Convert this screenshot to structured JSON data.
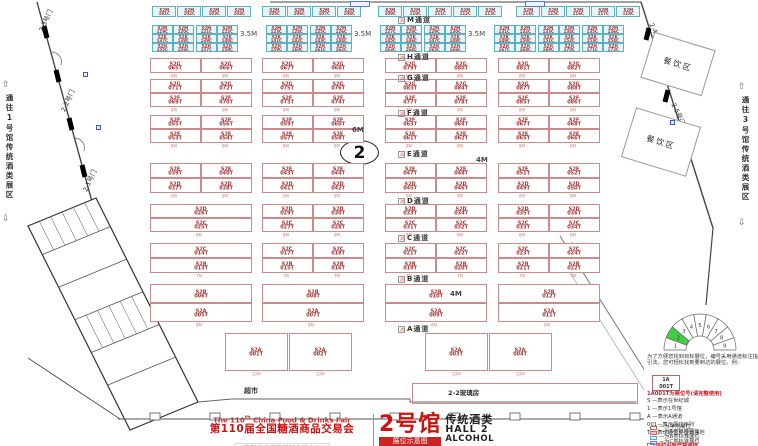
{
  "sides": {
    "left": "通往1号馆传统酒类展区",
    "right": "通往3号馆传统酒类展区"
  },
  "labels": {
    "market": "超市",
    "glass": "2-2玻璃房",
    "hall_circle": "2",
    "dining": "餐饮区",
    "aisle_icon": "消"
  },
  "gates": [
    {
      "label": "2-3号门",
      "x": 40,
      "y": 26,
      "r": -65
    },
    {
      "label": "2-2号门",
      "x": 62,
      "y": 106,
      "r": -65
    },
    {
      "label": "2-1号门",
      "x": 84,
      "y": 186,
      "r": -65
    },
    {
      "label": "2-4号门",
      "x": 652,
      "y": 18,
      "r": 65
    },
    {
      "label": "2-5号门",
      "x": 674,
      "y": 98,
      "r": 65
    }
  ],
  "dining_boxes": [
    {
      "x": 646,
      "y": 40,
      "w": 62,
      "h": 46,
      "r": 17
    },
    {
      "x": 627,
      "y": 116,
      "w": 66,
      "h": 50,
      "r": 17
    }
  ],
  "floor": {
    "aisles": [
      {
        "label": "M通道",
        "y": 15
      },
      {
        "label": "H通道",
        "y": 52
      },
      {
        "label": "G通道",
        "y": 73
      },
      {
        "label": "F通道",
        "y": 108
      },
      {
        "label": "E通道",
        "y": 149
      },
      {
        "label": "D通道",
        "y": 196
      },
      {
        "label": "C通道",
        "y": 233
      },
      {
        "label": "B通道",
        "y": 274
      },
      {
        "label": "A通道",
        "y": 324
      }
    ],
    "threefive": {
      "label": "3.5M",
      "positions": [
        [
          240,
          30
        ],
        [
          354,
          30
        ],
        [
          468,
          30
        ]
      ]
    },
    "dims": [
      [
        "6M",
        352,
        126
      ],
      [
        "4M",
        476,
        156
      ],
      [
        "4M",
        450,
        290
      ]
    ],
    "cyan_rows": [
      {
        "c": "S2M",
        "y": 6,
        "h": 11,
        "w": 24,
        "cells": [
          [
            "101C",
            152
          ],
          [
            "102C",
            177
          ],
          [
            "103C",
            202
          ],
          [
            "104C",
            227
          ],
          [
            "105C",
            262
          ],
          [
            "106C",
            287
          ],
          [
            "107C",
            312
          ],
          [
            "108C",
            337
          ],
          [
            "109C",
            378
          ],
          [
            "110C",
            403
          ],
          [
            "111C",
            428
          ],
          [
            "112C",
            453
          ],
          [
            "113C",
            478
          ],
          [
            "114C",
            516
          ],
          [
            "115C",
            541
          ],
          [
            "116C",
            566
          ],
          [
            "117C",
            591
          ],
          [
            "118C",
            616
          ]
        ]
      },
      {
        "c": "S2M",
        "y": 25,
        "h": 9,
        "w": 21,
        "cells": [
          [
            "119C",
            152
          ],
          [
            "120C",
            173
          ],
          [
            "121C",
            196
          ],
          [
            "122C",
            217
          ],
          [
            "123C",
            266
          ],
          [
            "124C",
            287
          ],
          [
            "125C",
            310
          ],
          [
            "126C",
            331
          ],
          [
            "127C",
            380
          ],
          [
            "128C",
            401
          ],
          [
            "129C",
            424
          ],
          [
            "130C",
            445
          ],
          [
            "131C",
            494
          ],
          [
            "132C",
            515
          ],
          [
            "133C",
            538
          ],
          [
            "134C",
            559
          ],
          [
            "135C",
            582
          ],
          [
            "136C",
            603
          ]
        ]
      },
      {
        "c": "S2K",
        "y": 34,
        "h": 9,
        "w": 21,
        "cells": [
          [
            "137C",
            152
          ],
          [
            "138C",
            173
          ],
          [
            "139C",
            196
          ],
          [
            "140C",
            217
          ],
          [
            "141C",
            266
          ],
          [
            "142C",
            287
          ],
          [
            "143C",
            310
          ],
          [
            "144C",
            331
          ],
          [
            "145C",
            380
          ],
          [
            "146C",
            401
          ],
          [
            "147C",
            424
          ],
          [
            "148C",
            445
          ],
          [
            "149C",
            494
          ],
          [
            "150C",
            515
          ],
          [
            "151C",
            538
          ],
          [
            "152C",
            559
          ],
          [
            "153C",
            582
          ],
          [
            "154C",
            603
          ]
        ]
      },
      {
        "c": "S2H",
        "y": 43,
        "h": 9,
        "w": 21,
        "cells": [
          [
            "155C",
            152
          ],
          [
            "156C",
            173
          ],
          [
            "157C",
            196
          ],
          [
            "158C",
            217
          ],
          [
            "159C",
            266
          ],
          [
            "160C",
            287
          ],
          [
            "161C",
            310
          ],
          [
            "162C",
            331
          ],
          [
            "163C",
            380
          ],
          [
            "164C",
            401
          ],
          [
            "165C",
            424
          ],
          [
            "166C",
            445
          ],
          [
            "167C",
            494
          ],
          [
            "168C",
            515
          ],
          [
            "169C",
            538
          ],
          [
            "170C",
            559
          ],
          [
            "171C",
            582
          ],
          [
            "172C",
            603
          ]
        ]
      }
    ],
    "pink_rows": [
      {
        "c": "S2G",
        "y": 58,
        "h": 15,
        "w": 51,
        "dim": "8M",
        "cells": [
          [
            "065T",
            150
          ],
          [
            "066T",
            201
          ],
          [
            "067T",
            262
          ],
          [
            "068T",
            313
          ],
          [
            "079T",
            385
          ],
          [
            "080T",
            436
          ],
          [
            "081T",
            498
          ],
          [
            "082T",
            549
          ]
        ]
      },
      {
        "c": "S2G",
        "y": 79,
        "h": 14,
        "w": 51,
        "dim": "",
        "cells": [
          [
            "071T",
            150
          ],
          [
            "072T",
            201
          ],
          [
            "075T",
            262
          ],
          [
            "076T",
            313
          ],
          [
            "083T",
            385
          ],
          [
            "084T",
            436
          ],
          [
            "087T",
            498
          ],
          [
            "088T",
            549
          ]
        ]
      },
      {
        "c": "S2F",
        "y": 93,
        "h": 14,
        "w": 51,
        "dim": "8M",
        "cells": [
          [
            "069T",
            150
          ],
          [
            "070T",
            201
          ],
          [
            "073T",
            262
          ],
          [
            "074T",
            313
          ],
          [
            "077T",
            385
          ],
          [
            "078T",
            436
          ],
          [
            "085T",
            498
          ],
          [
            "086T",
            549
          ]
        ]
      },
      {
        "c": "S2F",
        "y": 115,
        "h": 14,
        "w": 51,
        "dim": "",
        "cells": [
          [
            "055T",
            150
          ],
          [
            "056T",
            201
          ],
          [
            "059T",
            262
          ],
          [
            "060T",
            313
          ],
          [
            "063T",
            385
          ],
          [
            "064T",
            436
          ],
          [
            "067T",
            498
          ],
          [
            "068T",
            549
          ]
        ]
      },
      {
        "c": "S2E",
        "y": 129,
        "h": 14,
        "w": 51,
        "dim": "8M",
        "cells": [
          [
            "053T",
            150
          ],
          [
            "054T",
            201
          ],
          [
            "057T",
            262
          ],
          [
            "058T",
            313
          ],
          [
            "061T",
            385
          ],
          [
            "062T",
            436
          ],
          [
            "065T",
            498
          ],
          [
            "066T",
            549
          ]
        ]
      },
      {
        "c": "S2E",
        "y": 163,
        "h": 15,
        "w": 51,
        "dim": "",
        "cells": [
          [
            "039T",
            150
          ],
          [
            "040T",
            201
          ],
          [
            "043T",
            262
          ],
          [
            "044T",
            313
          ],
          [
            "047T",
            385
          ],
          [
            "048T",
            436
          ],
          [
            "051T",
            498
          ],
          [
            "052T",
            549
          ]
        ]
      },
      {
        "c": "S2D",
        "y": 178,
        "h": 15,
        "w": 51,
        "dim": "8M",
        "cells": [
          [
            "037T",
            150
          ],
          [
            "038T",
            201
          ],
          [
            "041T",
            262
          ],
          [
            "042T",
            313
          ],
          [
            "045T",
            385
          ],
          [
            "046T",
            436
          ],
          [
            "049T",
            498
          ],
          [
            "050T",
            549
          ]
        ]
      },
      {
        "c": "S2D",
        "y": 204,
        "h": 14,
        "w": 51,
        "dim": "",
        "cells": [
          [
            "026T",
            150,
            102
          ],
          [
            "029T",
            262
          ],
          [
            "030T",
            313
          ],
          [
            "033T",
            385
          ],
          [
            "034T",
            436
          ],
          [
            "035T",
            498
          ],
          [
            "036T",
            549
          ]
        ]
      },
      {
        "c": "S2C",
        "y": 218,
        "h": 14,
        "w": 51,
        "dim": "8M",
        "cells": [
          [
            "025T",
            150,
            102
          ],
          [
            "027T",
            262
          ],
          [
            "028T",
            313
          ],
          [
            "031T",
            385
          ],
          [
            "032T",
            436
          ],
          [
            "033T",
            498
          ],
          [
            "034T",
            549
          ]
        ]
      },
      {
        "c": "S2C",
        "y": 243,
        "h": 15,
        "w": 51,
        "dim": "",
        "cells": [
          [
            "014T",
            150,
            102
          ],
          [
            "017T",
            262
          ],
          [
            "018T",
            313
          ],
          [
            "021T",
            385
          ],
          [
            "022T",
            436
          ],
          [
            "023T",
            498
          ],
          [
            "024T",
            549
          ]
        ]
      },
      {
        "c": "S2B",
        "y": 258,
        "h": 15,
        "w": 51,
        "dim": "7M",
        "cells": [
          [
            "013T",
            150,
            102
          ],
          [
            "015T",
            262
          ],
          [
            "016T",
            313
          ],
          [
            "019T",
            385
          ],
          [
            "020T",
            436
          ],
          [
            "021T",
            498
          ],
          [
            "022T",
            549
          ]
        ]
      },
      {
        "c": "S2B",
        "y": 284,
        "h": 19,
        "w": 102,
        "dim": "",
        "cells": [
          [
            "006T",
            150
          ],
          [
            "008T",
            262
          ],
          [
            "010T",
            385
          ],
          [
            "012T",
            498
          ]
        ]
      },
      {
        "c": "S2A",
        "y": 303,
        "h": 19,
        "w": 102,
        "dim": "8M",
        "cells": [
          [
            "005T",
            150
          ],
          [
            "007T",
            262
          ],
          [
            "009T",
            385
          ],
          [
            "011T",
            498
          ]
        ]
      },
      {
        "c": "S2A",
        "y": 333,
        "h": 38,
        "w": 63,
        "dim": "10M",
        "cells": [
          [
            "001T",
            225
          ],
          [
            "002T",
            289
          ],
          [
            "003T",
            425
          ],
          [
            "004T",
            489
          ]
        ]
      }
    ],
    "hydrants": [
      [
        83,
        72
      ],
      [
        96,
        125
      ],
      [
        670,
        120
      ]
    ],
    "top_markers": [
      [
        350,
        1
      ],
      [
        525,
        1
      ]
    ]
  },
  "legend": {
    "intro": "为了方便您找到目标展位，编号采用通道标注指引法，您可轻松找到要到达的展位。例：",
    "example_line1": "1A",
    "example_line2": "001T",
    "example_note": "1A001T为展位号(请完整使用)",
    "keys": [
      "S —表示在世纪城",
      "1 —表示1号馆",
      "A —表示A通道",
      "001—表示展位序列",
      "T —表示展位类型为净地"
    ],
    "swatches": [
      {
        "label": "—为净地展位",
        "fill": "#ffffff",
        "border": "#cc6666"
      },
      {
        "label": "—为A类标准展位",
        "fill": "#f5c9c9",
        "border": "#cc6666"
      },
      {
        "label": "—为B类标准展位",
        "fill": "#d9f4f6",
        "border": "#66aabb"
      },
      {
        "label": "—为C类标准展位",
        "fill": "#d6ddf6",
        "border": "#7788cc"
      }
    ],
    "fire_note": "消防设施严禁遮挡",
    "dial_labels": [
      "1",
      "2",
      "3",
      "4",
      "5",
      "6",
      "7",
      "8",
      "9"
    ],
    "dial_highlight": "2",
    "dial_highlight_color": "#44cc44"
  },
  "title_block": {
    "en_pre": "The 110",
    "en_sup": "th",
    "en_post": " China Food & Drinks Fair",
    "cn": "第110届全国糖酒商品交易会",
    "venue": "成都世纪城新国际会展中心",
    "hall": "2号馆",
    "hall_type": "传统酒类",
    "hall_en": "HALL 2",
    "hall_en2": "ALCOHOL",
    "badge": "展位示意图"
  }
}
